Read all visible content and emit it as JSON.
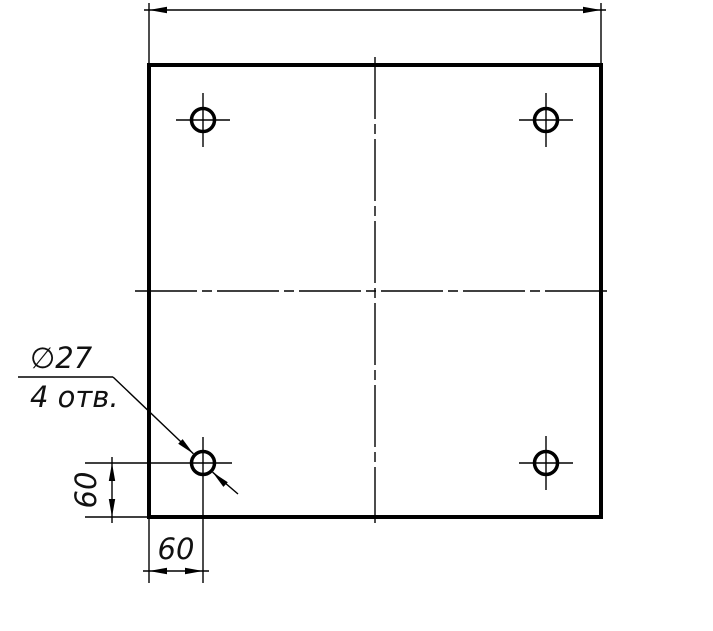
{
  "drawing": {
    "colors": {
      "line": "#000000",
      "background": "#ffffff"
    },
    "leader": {
      "hole_diameter_label": "∅27",
      "hole_count_label": "4 отв."
    },
    "dimensions": {
      "hole_offset_from_bottom": "60",
      "hole_offset_from_left": "60",
      "overall_width_label": ""
    }
  }
}
